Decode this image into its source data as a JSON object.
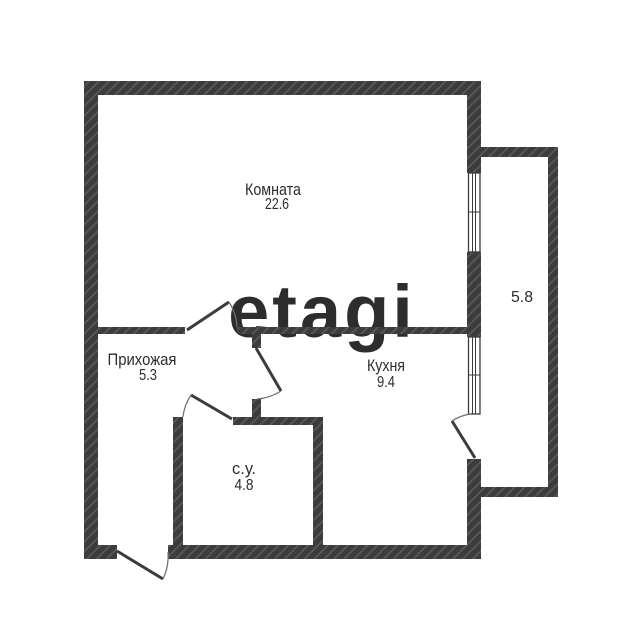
{
  "floorplan": {
    "watermark": "etagi",
    "rooms": {
      "komnata": {
        "name": "Комната",
        "area": "22.6"
      },
      "prihozhaya": {
        "name": "Прихожая",
        "area": "5.3"
      },
      "kuhnya": {
        "name": "Кухня",
        "area": "9.4"
      },
      "su": {
        "name": "с.у.",
        "area": "4.8"
      },
      "balkon": {
        "area": "5.8"
      }
    },
    "colors": {
      "wall": "#3c3c3c",
      "wall_hatch_line": "#585858",
      "label_text": "#2d2d2d",
      "watermark": "#f1efef",
      "background": "#ffffff"
    }
  }
}
